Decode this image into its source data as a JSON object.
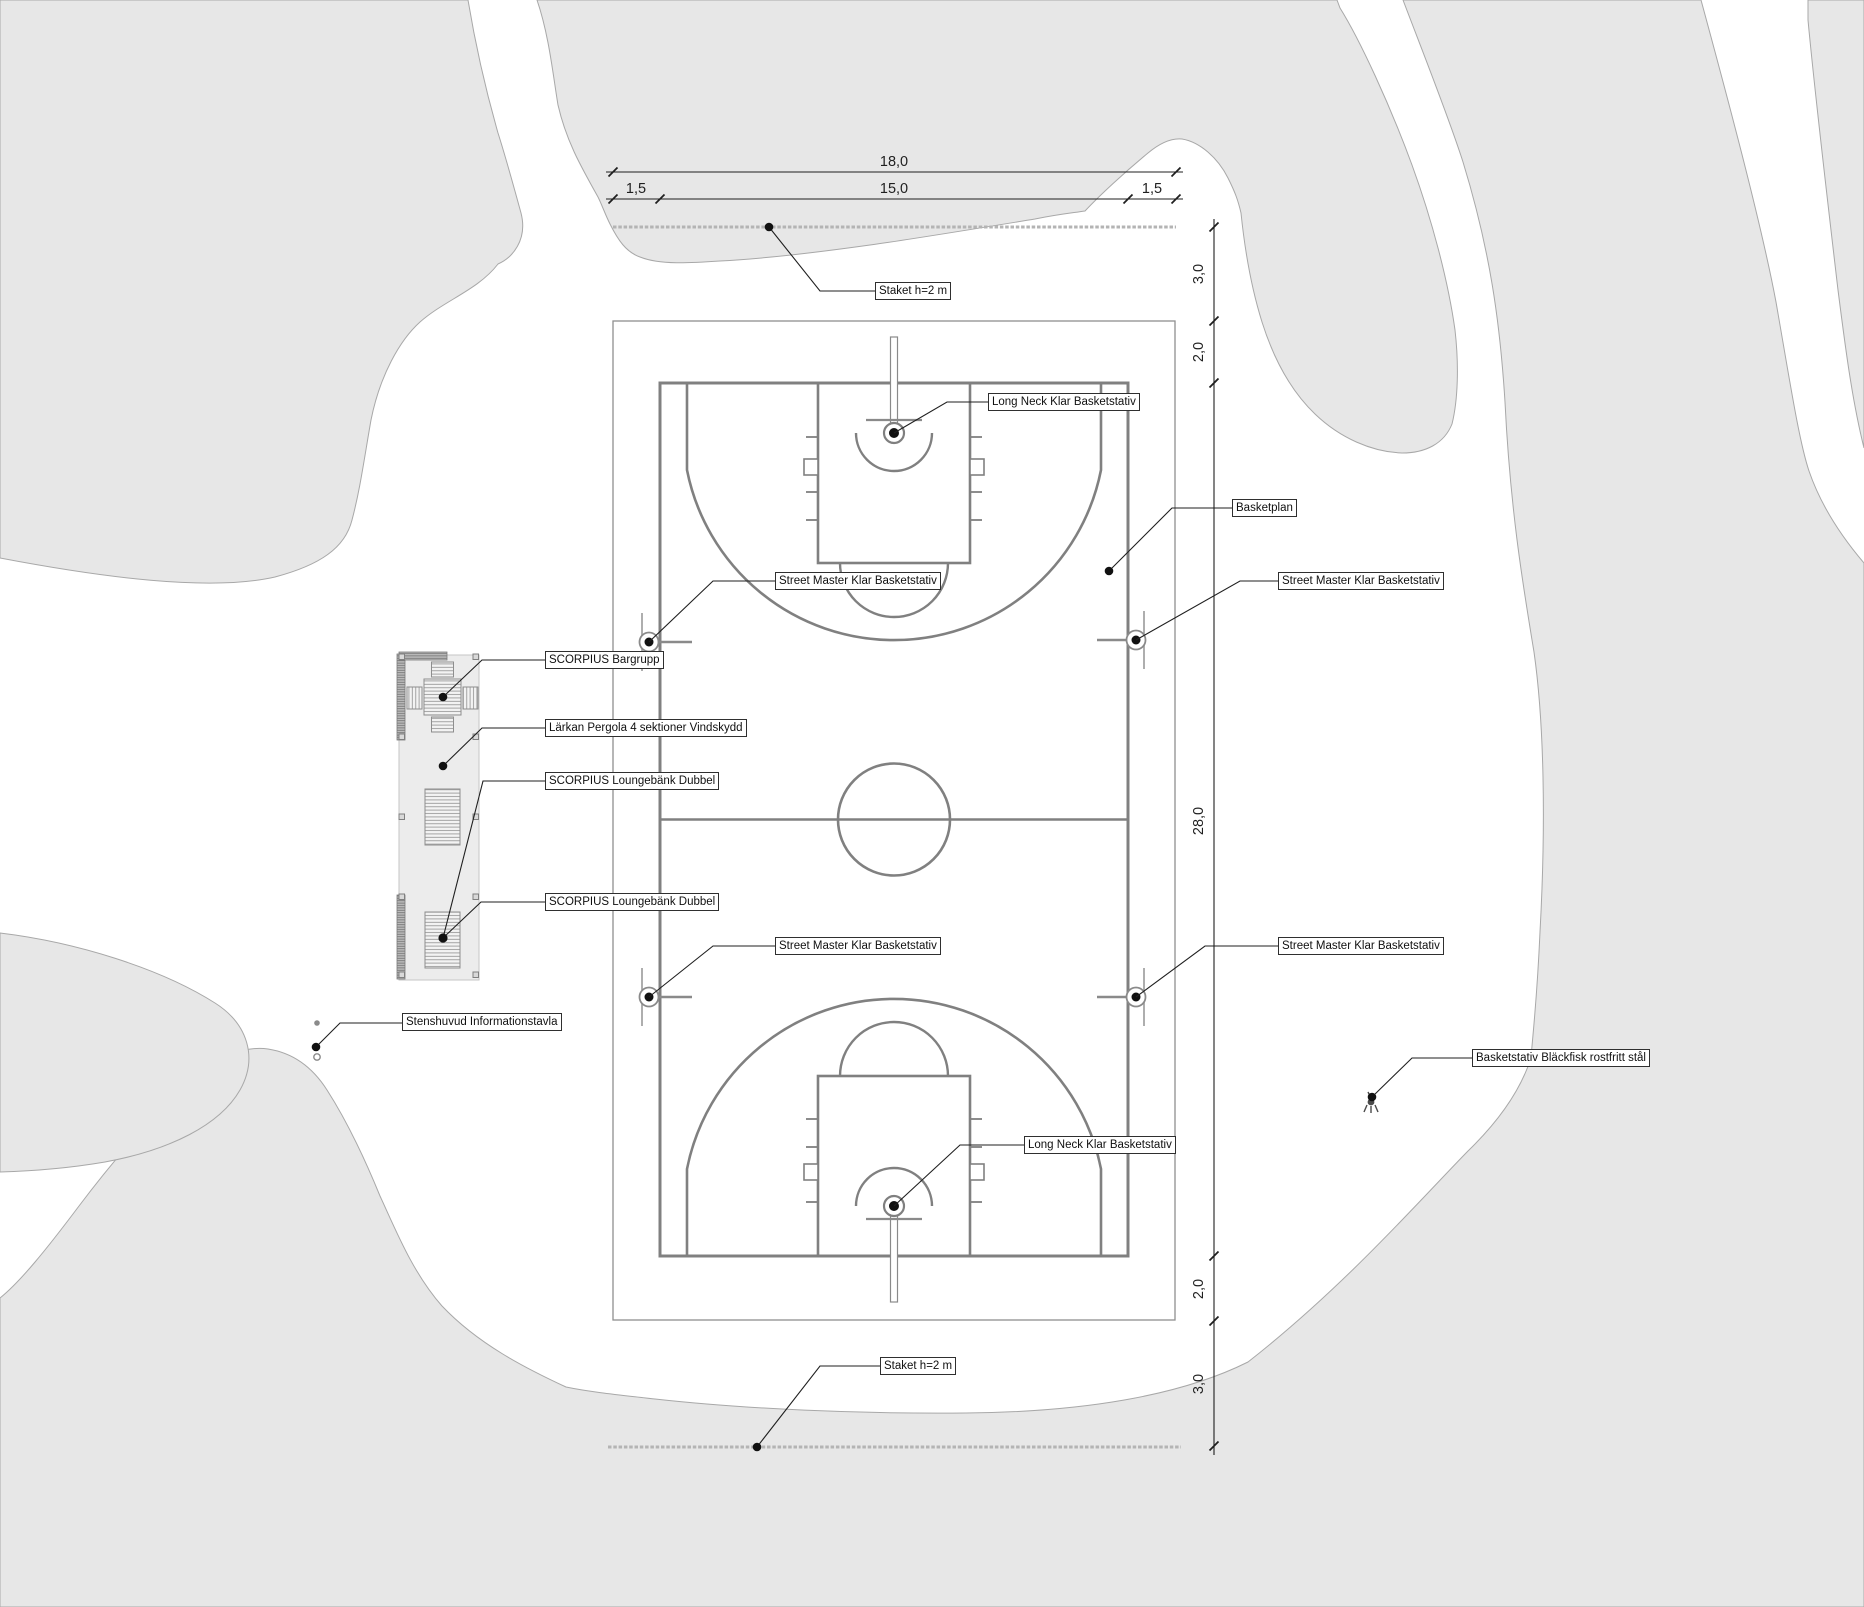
{
  "annotations": {
    "staket": "Staket h=2 m",
    "long_neck": "Long Neck Klar Basketstativ",
    "basketplan": "Basketplan",
    "street_master": "Street Master Klar Basketstativ",
    "bargrupp": "SCORPIUS Bargrupp",
    "pergola": "Lärkan Pergola 4 sektioner Vindskydd",
    "lounge": "SCORPIUS Loungebänk Dubbel",
    "infotavla": "Stenshuvud Informationstavla",
    "blackfisk": "Basketstativ Bläckfisk rostfritt stål"
  },
  "dimensions": {
    "horizontal": {
      "total": "18,0",
      "segments": [
        "1,5",
        "15,0",
        "1,5"
      ]
    },
    "vertical": {
      "segments": [
        "3,0",
        "2,0",
        "28,0",
        "2,0",
        "3,0"
      ]
    }
  },
  "colors": {
    "terrain": "#e7e7e7",
    "terrain_edge": "#a8a8a8",
    "court_line": "#808080",
    "fence": "#b4b4b4",
    "ink": "#1f1f1f"
  }
}
